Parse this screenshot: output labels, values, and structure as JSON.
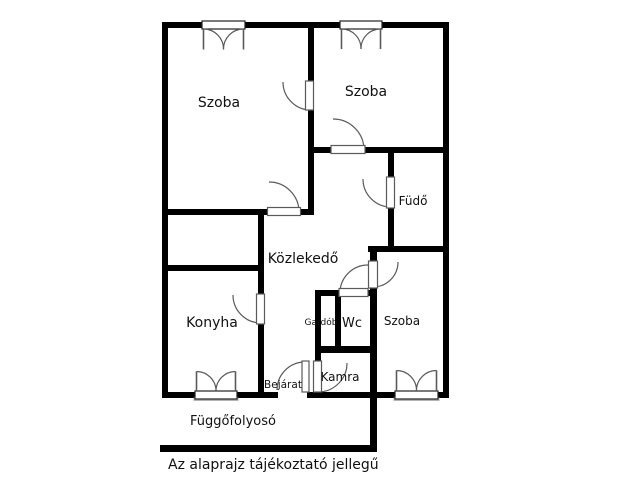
{
  "floorplan": {
    "note": "Az alaprajz tájékoztató jellegű",
    "colors": {
      "background": "#ffffff",
      "wall": "#000000",
      "line": "#5a5a5a",
      "sill": "#b3b3b3",
      "text": "#111111"
    },
    "labels": [
      {
        "name": "szoba-left",
        "text": "Szoba",
        "x": 219,
        "y": 107,
        "size": 14
      },
      {
        "name": "szoba-right",
        "text": "Szoba",
        "x": 366,
        "y": 96,
        "size": 14
      },
      {
        "name": "fudo",
        "text": "Füdő",
        "x": 413,
        "y": 205,
        "size": 12
      },
      {
        "name": "kozlekedo",
        "text": "Közlekedő",
        "x": 303,
        "y": 263,
        "size": 14
      },
      {
        "name": "konyha",
        "text": "Konyha",
        "x": 212,
        "y": 327,
        "size": 14
      },
      {
        "name": "gardob",
        "text": "Gardób",
        "x": 321,
        "y": 325,
        "size": 9
      },
      {
        "name": "wc",
        "text": "Wc",
        "x": 352,
        "y": 327,
        "size": 13
      },
      {
        "name": "szoba-bottom",
        "text": "Szoba",
        "x": 402,
        "y": 325,
        "size": 12
      },
      {
        "name": "kamra",
        "text": "Kamra",
        "x": 340,
        "y": 381,
        "size": 12
      },
      {
        "name": "bejarat",
        "text": "Bejárat",
        "x": 283,
        "y": 388,
        "size": 10.5
      },
      {
        "name": "fuggofolyoso",
        "text": "Függőfolyosó",
        "x": 233,
        "y": 425,
        "size": 13
      }
    ],
    "walls": [
      {
        "name": "outer-top",
        "rect": [
          162,
          22,
          287,
          6
        ]
      },
      {
        "name": "outer-left",
        "rect": [
          162,
          22,
          6,
          376
        ]
      },
      {
        "name": "outer-right",
        "rect": [
          443,
          22,
          6,
          376
        ]
      },
      {
        "name": "outer-bottom",
        "rect": [
          162,
          392,
          287,
          6
        ]
      },
      {
        "name": "szoba-divider",
        "rect": [
          308,
          22,
          6,
          193
        ]
      },
      {
        "name": "szoba-left-bottom",
        "rect": [
          162,
          209,
          152,
          6
        ]
      },
      {
        "name": "szoba-right-bottom",
        "rect": [
          308,
          147,
          141,
          6
        ]
      },
      {
        "name": "fudo-left",
        "rect": [
          388,
          147,
          6,
          105
        ]
      },
      {
        "name": "fudo-bottom",
        "rect": [
          368,
          246,
          81,
          6
        ]
      },
      {
        "name": "szoba-br-left-bar",
        "rect": [
          370,
          246,
          7,
          206
        ]
      },
      {
        "name": "konyha-top",
        "rect": [
          162,
          265,
          102,
          6
        ]
      },
      {
        "name": "konyha-right",
        "rect": [
          258,
          209,
          6,
          189
        ]
      },
      {
        "name": "gardob-left-bar",
        "rect": [
          315,
          290,
          6,
          108
        ]
      },
      {
        "name": "gardob-wc-divider",
        "rect": [
          335,
          290,
          6,
          62
        ]
      },
      {
        "name": "wc-top",
        "rect": [
          315,
          290,
          62,
          6
        ]
      },
      {
        "name": "wc-bottom-kamra-top",
        "rect": [
          315,
          346,
          62,
          7
        ]
      },
      {
        "name": "fuggofolyoso-edge",
        "rect": [
          160,
          445,
          217,
          7
        ]
      }
    ],
    "doors": [
      {
        "name": "door-szoba-szoba",
        "gap": [
          308,
          82,
          6,
          26
        ],
        "leaf": [
          305.5,
          81,
          8,
          29
        ],
        "arc": "M 283,82 A 28 28 0 0 0 311,110"
      },
      {
        "name": "door-szoba-left",
        "gap": [
          269,
          209,
          30,
          6
        ],
        "leaf": [
          267.5,
          207.5,
          33,
          8
        ],
        "arc": "M 299,212 A 30 30 0 0 0 269,182"
      },
      {
        "name": "door-szoba-right",
        "gap": [
          332,
          147,
          33,
          6
        ],
        "leaf": [
          331,
          145.5,
          34,
          8
        ],
        "arc": "M 364,150 A 31 31 0 0 0 333,119"
      },
      {
        "name": "door-fudo",
        "gap": [
          388,
          178,
          6,
          29
        ],
        "leaf": [
          386.5,
          177,
          8,
          31
        ],
        "arc": "M 391,207 A 28 28 0 0 1 363,179"
      },
      {
        "name": "door-wc",
        "gap": [
          340,
          290,
          28,
          6
        ],
        "leaf": [
          339,
          288.5,
          29,
          8
        ],
        "arc": "M 340,293 A 28 28 0 0 1 368,265"
      },
      {
        "name": "door-szoba-bottom",
        "gap": [
          370,
          262,
          7,
          25
        ],
        "leaf": [
          368.5,
          261,
          9,
          27
        ],
        "arc": "M 373,287 A 25 25 0 0 0 398,262"
      },
      {
        "name": "door-konyha",
        "gap": [
          258,
          295,
          6,
          28
        ],
        "leaf": [
          256.5,
          294,
          8,
          30
        ],
        "arc": "M 261,323 A 28 28 0 0 1 233,295"
      },
      {
        "name": "door-kamra",
        "gap": [
          315,
          362,
          6,
          30
        ],
        "leaf": [
          313.5,
          361,
          8,
          31
        ],
        "arc": "M 318,392 A 29 29 0 0 0 347,363"
      },
      {
        "name": "door-bejarat",
        "gap": [
          278,
          392,
          29,
          6
        ],
        "leaf": [
          302,
          361,
          7,
          31
        ],
        "arc": "M 305,362 A 28 28 0 0 0 277,390"
      }
    ],
    "windows": [
      {
        "name": "window-szoba-left-top",
        "frame": [
          202,
          21,
          43,
          8
        ],
        "sill": null,
        "leaves": [
          "M 203.5,29 L 203.5,49.5",
          "M 243.5,29 L 243.5,49.5"
        ],
        "arcs": [
          "M 203.5,29 A 20 20 0 0 1 223.5,49.5",
          "M 243.5,29 A 20 20 0 0 0 223.5,49.5"
        ]
      },
      {
        "name": "window-szoba-right-top",
        "frame": [
          340,
          21,
          42,
          8
        ],
        "sill": null,
        "leaves": [
          "M 341.5,29 L 341.5,49",
          "M 380.5,29 L 380.5,49"
        ],
        "arcs": [
          "M 341.5,29 A 19.5 19.5 0 0 1 361,49",
          "M 380.5,29 A 19.5 19.5 0 0 0 361,49"
        ]
      },
      {
        "name": "window-konyha-bottom",
        "frame": [
          195,
          391,
          42,
          8
        ],
        "sill": [
          193.5,
          397.5,
          45,
          3.5
        ],
        "leaves": [
          "M 196.5,391 L 196.5,371.5",
          "M 235.5,391 L 235.5,371.5"
        ],
        "arcs": [
          "M 196.5,371.5 A 19.5 19.5 0 0 1 216,391",
          "M 235.5,371.5 A 19.5 19.5 0 0 0 216,391"
        ]
      },
      {
        "name": "window-szoba-bottom",
        "frame": [
          395,
          391,
          43,
          8
        ],
        "sill": [
          393.5,
          397.5,
          46,
          3.5
        ],
        "leaves": [
          "M 396.5,391 L 396.5,370.5",
          "M 436.5,391 L 436.5,370.5"
        ],
        "arcs": [
          "M 396.5,370.5 A 20 20 0 0 1 416.5,391",
          "M 436.5,370.5 A 20 20 0 0 0 416.5,391"
        ]
      }
    ]
  }
}
